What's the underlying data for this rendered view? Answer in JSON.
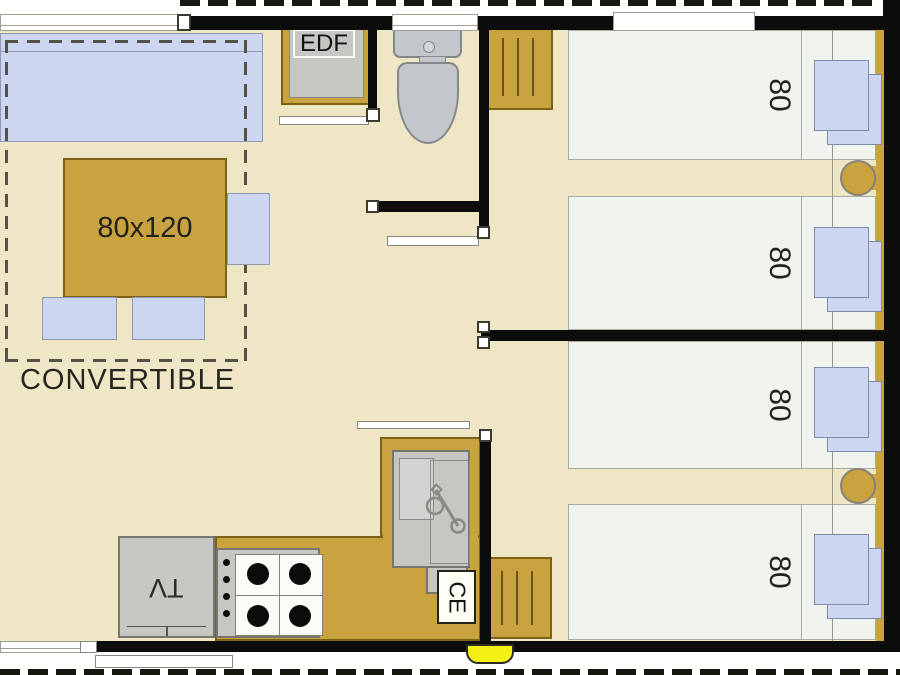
{
  "labels": {
    "convertible": "CONVERTIBLE",
    "table_size": "80x120",
    "edf": "EDF",
    "tv": "TV",
    "water_heater": "CE",
    "bed_widths": [
      "80",
      "80",
      "80",
      "80"
    ]
  },
  "colors": {
    "floor": "#efe6c6",
    "gold": "#c9a340",
    "gold_border": "#7c6214",
    "blue": "#ccd6f0",
    "blue_border": "#8f97b5",
    "bed": "#f1f3ee",
    "bed_border": "#a8aba0",
    "gray": "#c6c6c3",
    "gray_border": "#76756e",
    "wall": "#0c0c0a",
    "yellow": "#f4f016",
    "outline": "#55524a"
  }
}
